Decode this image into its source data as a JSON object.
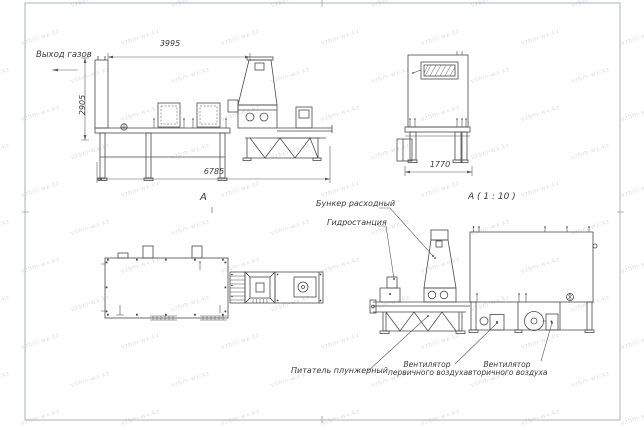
{
  "drawing": {
    "labels": {
      "gas_outlet": "Выход газов",
      "view_a": "А",
      "detail_a": "А ( 1 : 10 )",
      "bunker": "Бункер расходный",
      "hydrostation": "Гидростанция",
      "feeder": "Питатель плунжерный",
      "fan_primary_l1": "Вентилятор",
      "fan_primary_l2": "первичного воздуха",
      "fan_secondary_l1": "Вентилятор",
      "fan_secondary_l2": "вторичного воздуха"
    },
    "dimensions": {
      "front_top_width": "3995",
      "front_height": "2905",
      "front_total_width": "6785",
      "side_width": "1770"
    },
    "colors": {
      "line": "#4a4a4a",
      "dim": "#5a5a5a",
      "frame": "#9aa0a6",
      "watermark": "#bfc3cd",
      "background": "#ffffff"
    },
    "watermark_text": "vzbm-wx.kz"
  }
}
